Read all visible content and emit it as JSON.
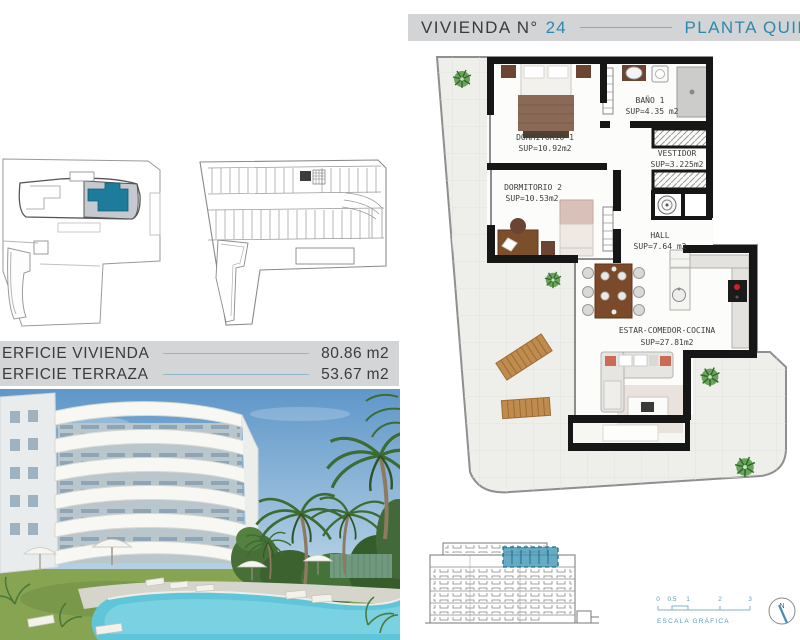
{
  "title_bar": {
    "prefix": "VIVIENDA N°",
    "unit_number": "24",
    "plant_label": "PLANTA QUIN"
  },
  "surface_panel": {
    "rows": [
      {
        "label": "ERFICIE VIVIENDA",
        "value": "80.86 m2"
      },
      {
        "label": "ERFICIE TERRAZA",
        "value": "53.67 m2"
      }
    ]
  },
  "floor_plan": {
    "rooms": [
      {
        "name": "DORMITORIO 1",
        "sup": "SUP=10.92m2"
      },
      {
        "name": "BAÑO 1",
        "sup": "SUP=4.35 m2"
      },
      {
        "name": "VESTIDOR",
        "sup": "SUP=3.225m2"
      },
      {
        "name": "DORMITORIO 2",
        "sup": "SUP=10.53m2"
      },
      {
        "name": "HALL",
        "sup": "SUP=7.64 m2"
      },
      {
        "name": "ESTAR-COMEDOR-COCINA",
        "sup": "SUP=27.81m2"
      }
    ]
  },
  "scale_bar": {
    "ticks": [
      "0",
      "0.5",
      "1",
      "2",
      "3"
    ],
    "label": "ESCALA GRÁFICA"
  },
  "north_indicator": {
    "label": "N"
  },
  "colors": {
    "teal_text": "#2d89ad",
    "teal_fill": "#1d7b9c",
    "elevation_highlight": "#4095b5",
    "band_gray": "#d2d4d6",
    "wall_black": "#161616",
    "accent_red": "#cc2222",
    "pool_blue": "#5fc6da",
    "lawn_green": "#86a452",
    "text_dark": "#3b3b3b"
  }
}
